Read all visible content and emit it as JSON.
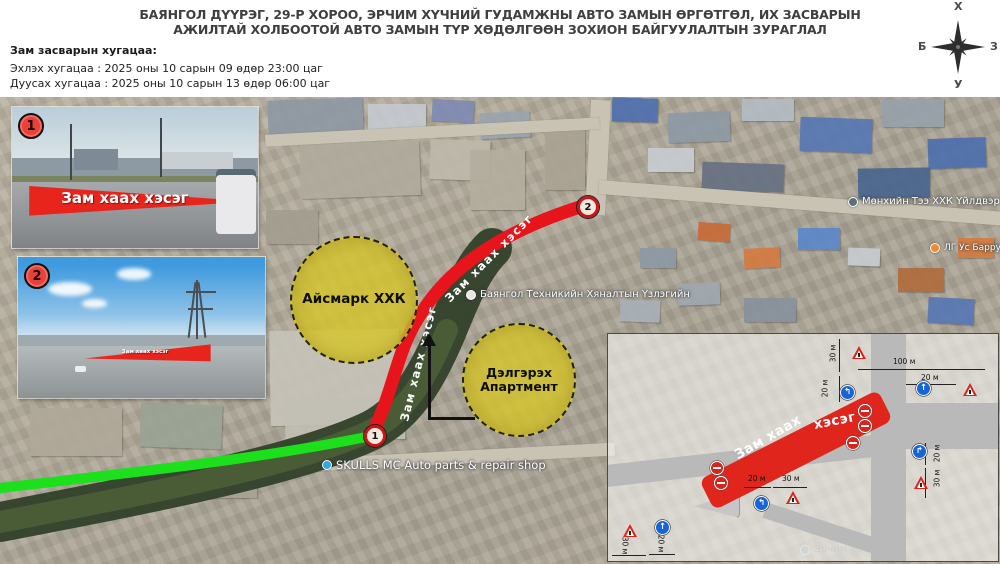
{
  "title": {
    "line1": "БАЯНГОЛ ДҮҮРЭГ, 29-Р ХОРОО, ЭРЧИМ ХҮЧНИЙ ГУДАМЖНЫ АВТО ЗАМЫН ӨРГӨТГӨЛ, ИХ ЗАСВАРЫН",
    "line2": "АЖИЛТАЙ ХОЛБООТОЙ АВТО ЗАМЫН ТҮР ХӨДӨЛГӨӨН ЗОХИОН БАЙГУУЛАЛТЫН ЗУРАГЛАЛ"
  },
  "schedule": {
    "heading": "Зам засварын хугацаа:",
    "start": "Эхлэх хугацаа : 2025 оны 10 сарын 09 өдөр 23:00 цаг",
    "end": "Дуусах хугацаа : 2025 оны 10 сарын 13 өдөр 06:00 цаг"
  },
  "compass": {
    "north": "Х",
    "south": "У",
    "west": "Б",
    "east": "З"
  },
  "photos": [
    {
      "number": "1",
      "caption": "Зам хаах хэсэг"
    },
    {
      "number": "2",
      "caption": "Зам хаах хэсэг"
    }
  ],
  "zones": [
    {
      "line1": "Айсмарк ХХК",
      "line2": ""
    },
    {
      "line1": "Дэлгэрэх",
      "line2": "Апартмент"
    }
  ],
  "markers": [
    {
      "number": "1"
    },
    {
      "number": "2"
    }
  ],
  "route_labels": [
    {
      "text": "Зам хаах хэсэг",
      "x": 404,
      "y": 414,
      "rot": -76
    },
    {
      "text": "Зам хаах хэсэг",
      "x": 447,
      "y": 293,
      "rot": -45
    }
  ],
  "map_labels": [
    {
      "text": "SKULLS MC Auto parts & repair shop",
      "x": 322,
      "y": 458,
      "size": 11.5,
      "dot": "#35a7e0",
      "dim": false
    },
    {
      "text": "Баянгол Техникийн Хяналтын Үзлэгийн",
      "x": 466,
      "y": 289,
      "size": 10,
      "dot": "#e8e6e0",
      "dim": false
    },
    {
      "text": "Мөнхийн Тээ ХХК Үйлдвэр",
      "x": 848,
      "y": 196,
      "size": 10,
      "dot": "#5f6f7d",
      "dim": false
    },
    {
      "text": "ЛГ Ус Барру Ба",
      "x": 930,
      "y": 243,
      "size": 9,
      "dot": "#ef8c2a",
      "dim": false
    },
    {
      "text": "Эрчим хотхон",
      "x": 800,
      "y": 544,
      "size": 10,
      "dot": "#98a0a6",
      "dim": true
    }
  ],
  "inset": {
    "closures": [
      {
        "text": "Зам хаах",
        "x": 735,
        "y": 447,
        "rot": -30
      },
      {
        "text": "хэсэг",
        "x": 813,
        "y": 416,
        "rot": -11
      }
    ],
    "dimensions": [
      {
        "text": "100 м",
        "x": 893,
        "y": 357,
        "rot": 0,
        "line": {
          "x": 858,
          "y": 369,
          "len": 127,
          "vert": false
        }
      },
      {
        "text": "20 м",
        "x": 921,
        "y": 373,
        "rot": 0,
        "line": {
          "x": 906,
          "y": 384,
          "len": 50,
          "vert": false
        }
      },
      {
        "text": "30 м",
        "x": 824,
        "y": 349,
        "rot": -90,
        "line": {
          "x": 839,
          "y": 339,
          "len": 33,
          "vert": true
        }
      },
      {
        "text": "20 м",
        "x": 816,
        "y": 384,
        "rot": -90,
        "line": {
          "x": 839,
          "y": 376,
          "len": 26,
          "vert": true
        }
      },
      {
        "text": "20 м",
        "x": 748,
        "y": 474,
        "rot": 0,
        "line": {
          "x": 744,
          "y": 487,
          "len": 27,
          "vert": false
        }
      },
      {
        "text": "30 м",
        "x": 782,
        "y": 474,
        "rot": 0,
        "line": {
          "x": 773,
          "y": 487,
          "len": 34,
          "vert": false
        }
      },
      {
        "text": "20 м",
        "x": 928,
        "y": 449,
        "rot": -90,
        "line": {
          "x": 925,
          "y": 443,
          "len": 22,
          "vert": true
        }
      },
      {
        "text": "30 м",
        "x": 928,
        "y": 474,
        "rot": -90,
        "line": {
          "x": 925,
          "y": 468,
          "len": 30,
          "vert": true
        }
      },
      {
        "text": "30 м",
        "x": 616,
        "y": 541,
        "rot": 90,
        "line": {
          "x": 612,
          "y": 555,
          "len": 34,
          "vert": false
        }
      },
      {
        "text": "20 м",
        "x": 652,
        "y": 539,
        "rot": 90,
        "line": {
          "x": 649,
          "y": 554,
          "len": 26,
          "vert": false
        }
      }
    ],
    "signs": [
      {
        "type": "mandatory",
        "glyph": "↰",
        "x": 840,
        "y": 385
      },
      {
        "type": "mandatory",
        "glyph": "↑",
        "x": 916,
        "y": 381
      },
      {
        "type": "mandatory",
        "glyph": "↱",
        "x": 912,
        "y": 444
      },
      {
        "type": "mandatory",
        "glyph": "↑",
        "x": 655,
        "y": 520
      },
      {
        "type": "mandatory",
        "glyph": "↰",
        "x": 754,
        "y": 496
      },
      {
        "type": "warning",
        "x": 852,
        "y": 346
      },
      {
        "type": "warning",
        "x": 963,
        "y": 383
      },
      {
        "type": "warning",
        "x": 914,
        "y": 476
      },
      {
        "type": "warning",
        "x": 623,
        "y": 524
      },
      {
        "type": "warning",
        "x": 786,
        "y": 491
      },
      {
        "type": "no-entry",
        "x": 858,
        "y": 404
      },
      {
        "type": "no-entry",
        "x": 858,
        "y": 419
      },
      {
        "type": "no-entry",
        "x": 846,
        "y": 436
      },
      {
        "type": "no-entry",
        "x": 710,
        "y": 461
      },
      {
        "type": "no-entry",
        "x": 714,
        "y": 476
      }
    ]
  },
  "colors": {
    "closed_route": "#e8141c",
    "open_route": "#1ce01c",
    "zone_fill": "#d6c42c"
  }
}
